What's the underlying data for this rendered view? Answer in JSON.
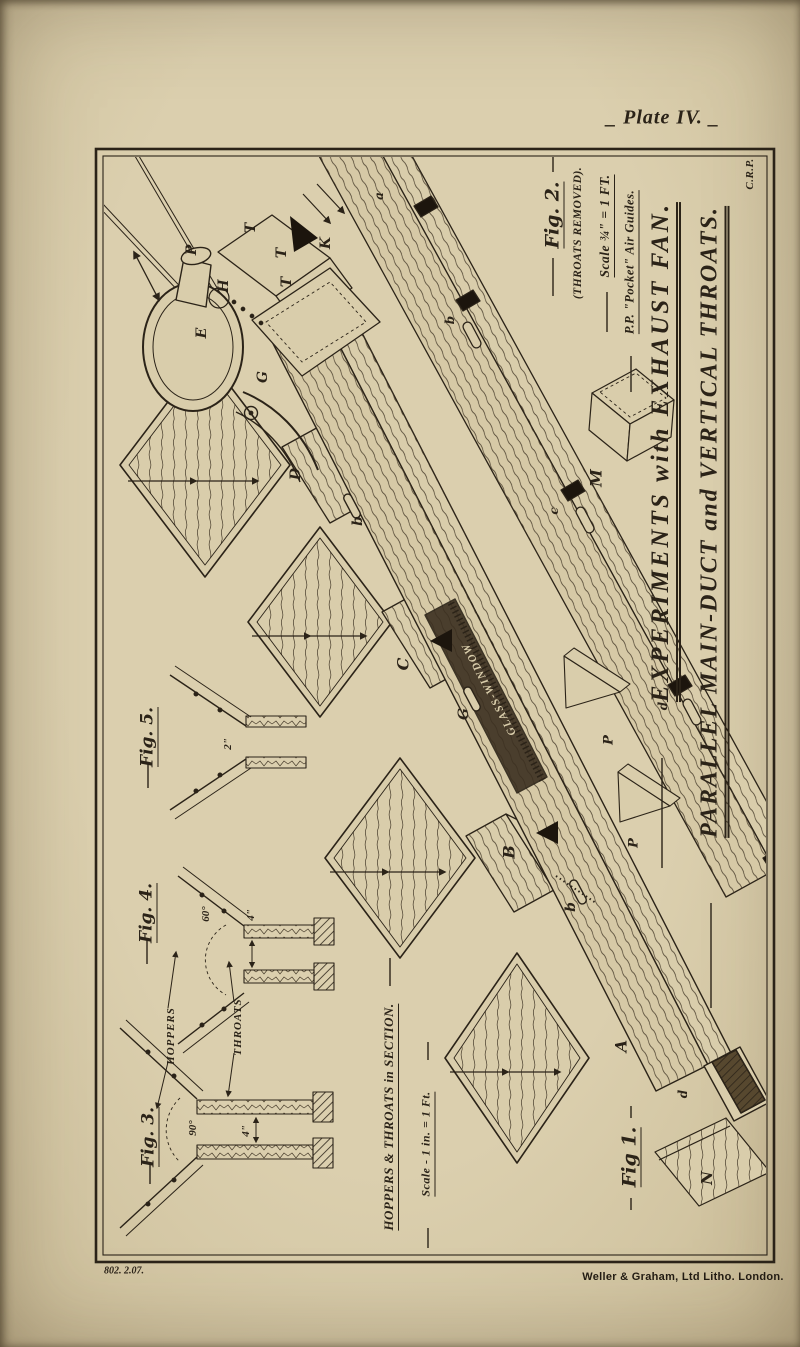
{
  "page": {
    "plate_title": "_ Plate IV. _",
    "print_code": "802. 2.07.",
    "printer_credit": "Weller & Graham, Ltd Litho. London."
  },
  "titles": {
    "experiments": "EXPERIMENTS with EXHAUST FAN.",
    "parallel": "PARALLEL MAIN-DUCT and VERTICAL THROATS.",
    "initials": "C.R.P."
  },
  "fig1": {
    "label": "Fig 1.",
    "air_guides_note": "P.P. \"Pocket\" Air Guides.",
    "glass_window": "GLASS-WINDOW",
    "parts": {
      "fan_outlet": "P",
      "fan_inlet": "H",
      "fan": "E",
      "elbow": "G",
      "duct": "D",
      "box_t1": "T",
      "box_t2": "T",
      "box_t3": "T",
      "box_k": "K",
      "batten1": "b",
      "clamp": "G",
      "batten2": "b",
      "throat_c": "C",
      "throat_b": "B",
      "end_section": "A",
      "end_cleat": "d",
      "loose_board": "N",
      "guide1": "P",
      "guide2": "P"
    }
  },
  "fig2": {
    "label": "Fig. 2.",
    "note": "(THROATS REMOVED).",
    "scale": "Scale ¾\" = 1 FT.",
    "parts": {
      "main_duct": "M",
      "slot_a": "a",
      "slot_b": "b",
      "slot_c": "c",
      "slot_d": "d"
    }
  },
  "sections": {
    "heading": "HOPPERS & THROATS in SECTION.",
    "scale": "Scale - 1 in. = 1 Ft.",
    "throats_callout": "THROATS",
    "hoppers_callout": "HOPPERS",
    "fig3": {
      "label": "Fig. 3.",
      "angle": "90°",
      "dim": "4\""
    },
    "fig4": {
      "label": "Fig. 4.",
      "angle": "60°",
      "dim": "4\""
    },
    "fig5": {
      "label": "Fig. 5.",
      "dim": "2\""
    }
  }
}
